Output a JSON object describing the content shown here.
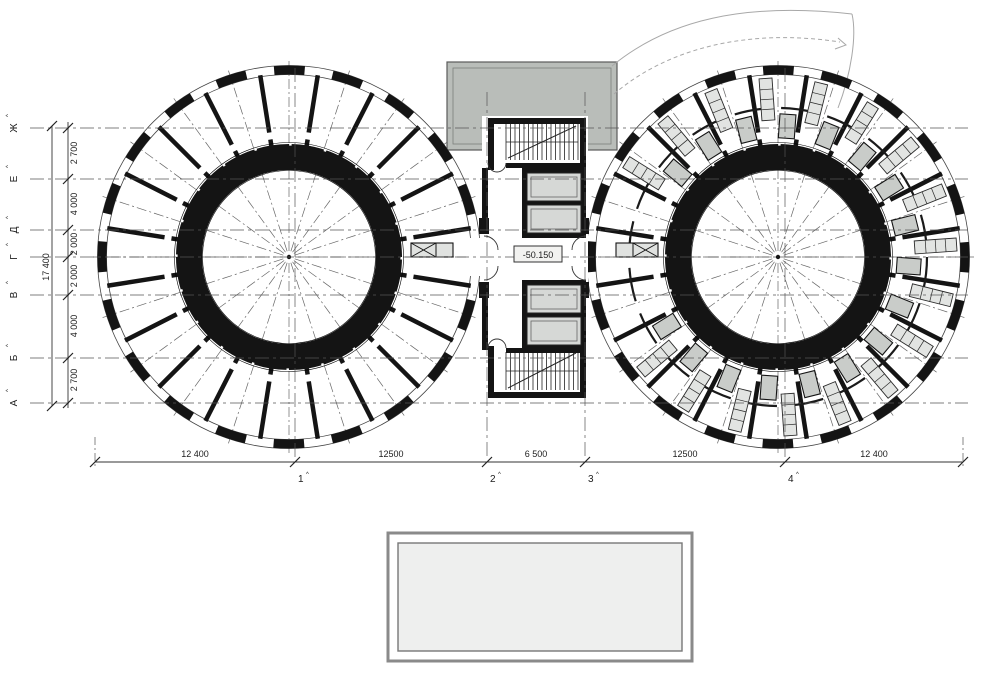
{
  "plan": {
    "elevation_label": "-50.150",
    "axis_sup": "^",
    "row_axes": [
      "Ж",
      "Е",
      "Д",
      "Г",
      "В",
      "Б",
      "А"
    ],
    "row_dims": [
      "2 700",
      "4 000",
      "2 000",
      "2 000",
      "4 000",
      "2 700"
    ],
    "row_total": "17 400",
    "col_axes": [
      "1",
      "2",
      "3",
      "4"
    ],
    "col_dims": [
      "12 400",
      "12500",
      "6 500",
      "12500",
      "12 400"
    ]
  },
  "colors": {
    "wall": "#141414",
    "thin_line": "#333333",
    "axis_line": "#555555",
    "roof_gray": "#b9bdb9",
    "cell_gray": "#d6d8d6",
    "pod_gray": "#c9ccc9",
    "counter_gray": "#e2e4e2",
    "pool_fill": "#eeefee",
    "canopy_line": "#a8a8a8"
  }
}
